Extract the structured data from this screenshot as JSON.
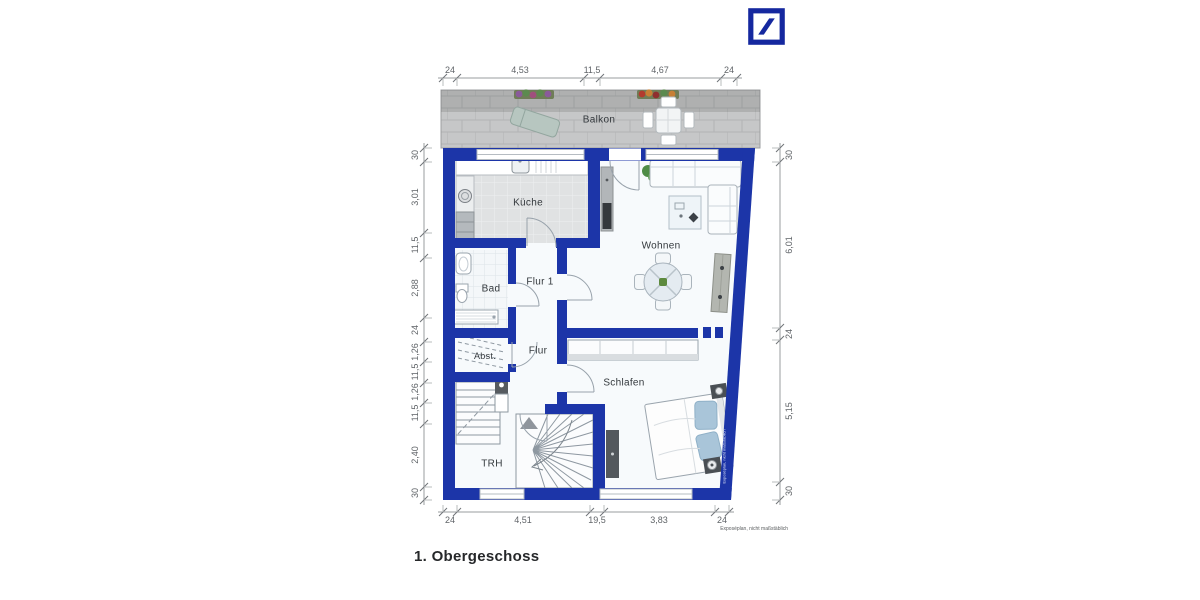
{
  "plan": {
    "title": "1. Obergeschoss",
    "footnote": "Exposéplan, nicht maßstäblich",
    "watermark": "Exposéplan, nicht maßstäblich"
  },
  "rooms": {
    "balkon": "Balkon",
    "kueche": "Küche",
    "wohnen": "Wohnen",
    "bad": "Bad",
    "flur1": "Flur 1",
    "flur": "Flur",
    "abst": "Abst.",
    "schlafen": "Schlafen",
    "trh": "TRH"
  },
  "dimensions": {
    "top": [
      "24",
      "4,53",
      "11,5",
      "4,67",
      "24"
    ],
    "left": [
      "30",
      "3,01",
      "11,5",
      "2,88",
      "24",
      "1,26",
      "11,5",
      "1,26",
      "11,5",
      "2,40",
      "30"
    ],
    "right": [
      "30",
      "6,01",
      "24",
      "5,15",
      "30"
    ],
    "bottom": [
      "24",
      "4,51",
      "19,5",
      "3,83",
      "24"
    ]
  },
  "colors": {
    "wall": "#1c35a8",
    "logo": "#15289f",
    "balcony_tile": "#c6c7c8",
    "room_bg": "#f7fafc"
  }
}
